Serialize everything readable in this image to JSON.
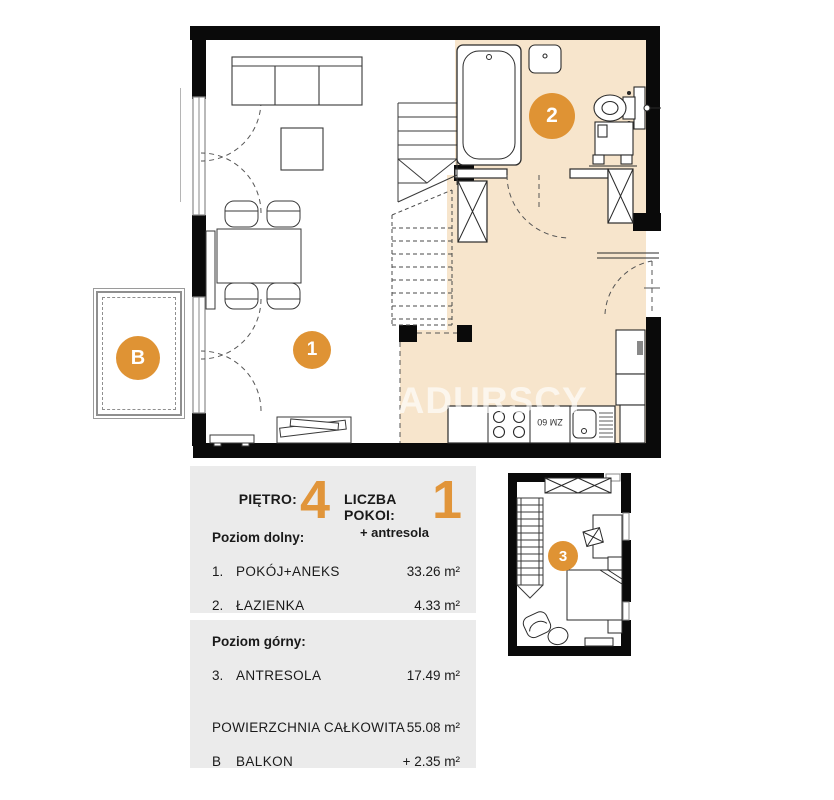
{
  "watermark": "SADURSCY",
  "accent_orange": "#DF9334",
  "room_fill_beige": "#F7E5CC",
  "panel_gray": "#EBEBEB",
  "markers": {
    "living": "1",
    "bathroom": "2",
    "mezzanine": "3",
    "balcony": "B"
  },
  "appliance_label": "ZM 60",
  "info": {
    "floor_label": "PIĘTRO:",
    "floor_value": "4",
    "rooms_label": "LICZBA POKOI:",
    "rooms_value": "1",
    "rooms_note": "+ antresola",
    "lower_section_title": "Poziom dolny:",
    "lower_rooms": [
      {
        "no": "1.",
        "name": "POKÓJ+ANEKS",
        "area": "33.26 m²"
      },
      {
        "no": "2.",
        "name": "ŁAZIENKA",
        "area": "4.33 m²"
      }
    ],
    "upper_section_title": "Poziom górny:",
    "upper_rooms": [
      {
        "no": "3.",
        "name": "ANTRESOLA",
        "area": "17.49 m²"
      }
    ],
    "total_label": "POWIERZCHNIA CAŁKOWITA",
    "total_area": "55.08 m²",
    "balcony_no": "B",
    "balcony_label": "BALKON",
    "balcony_area": "+ 2.35 m²"
  }
}
